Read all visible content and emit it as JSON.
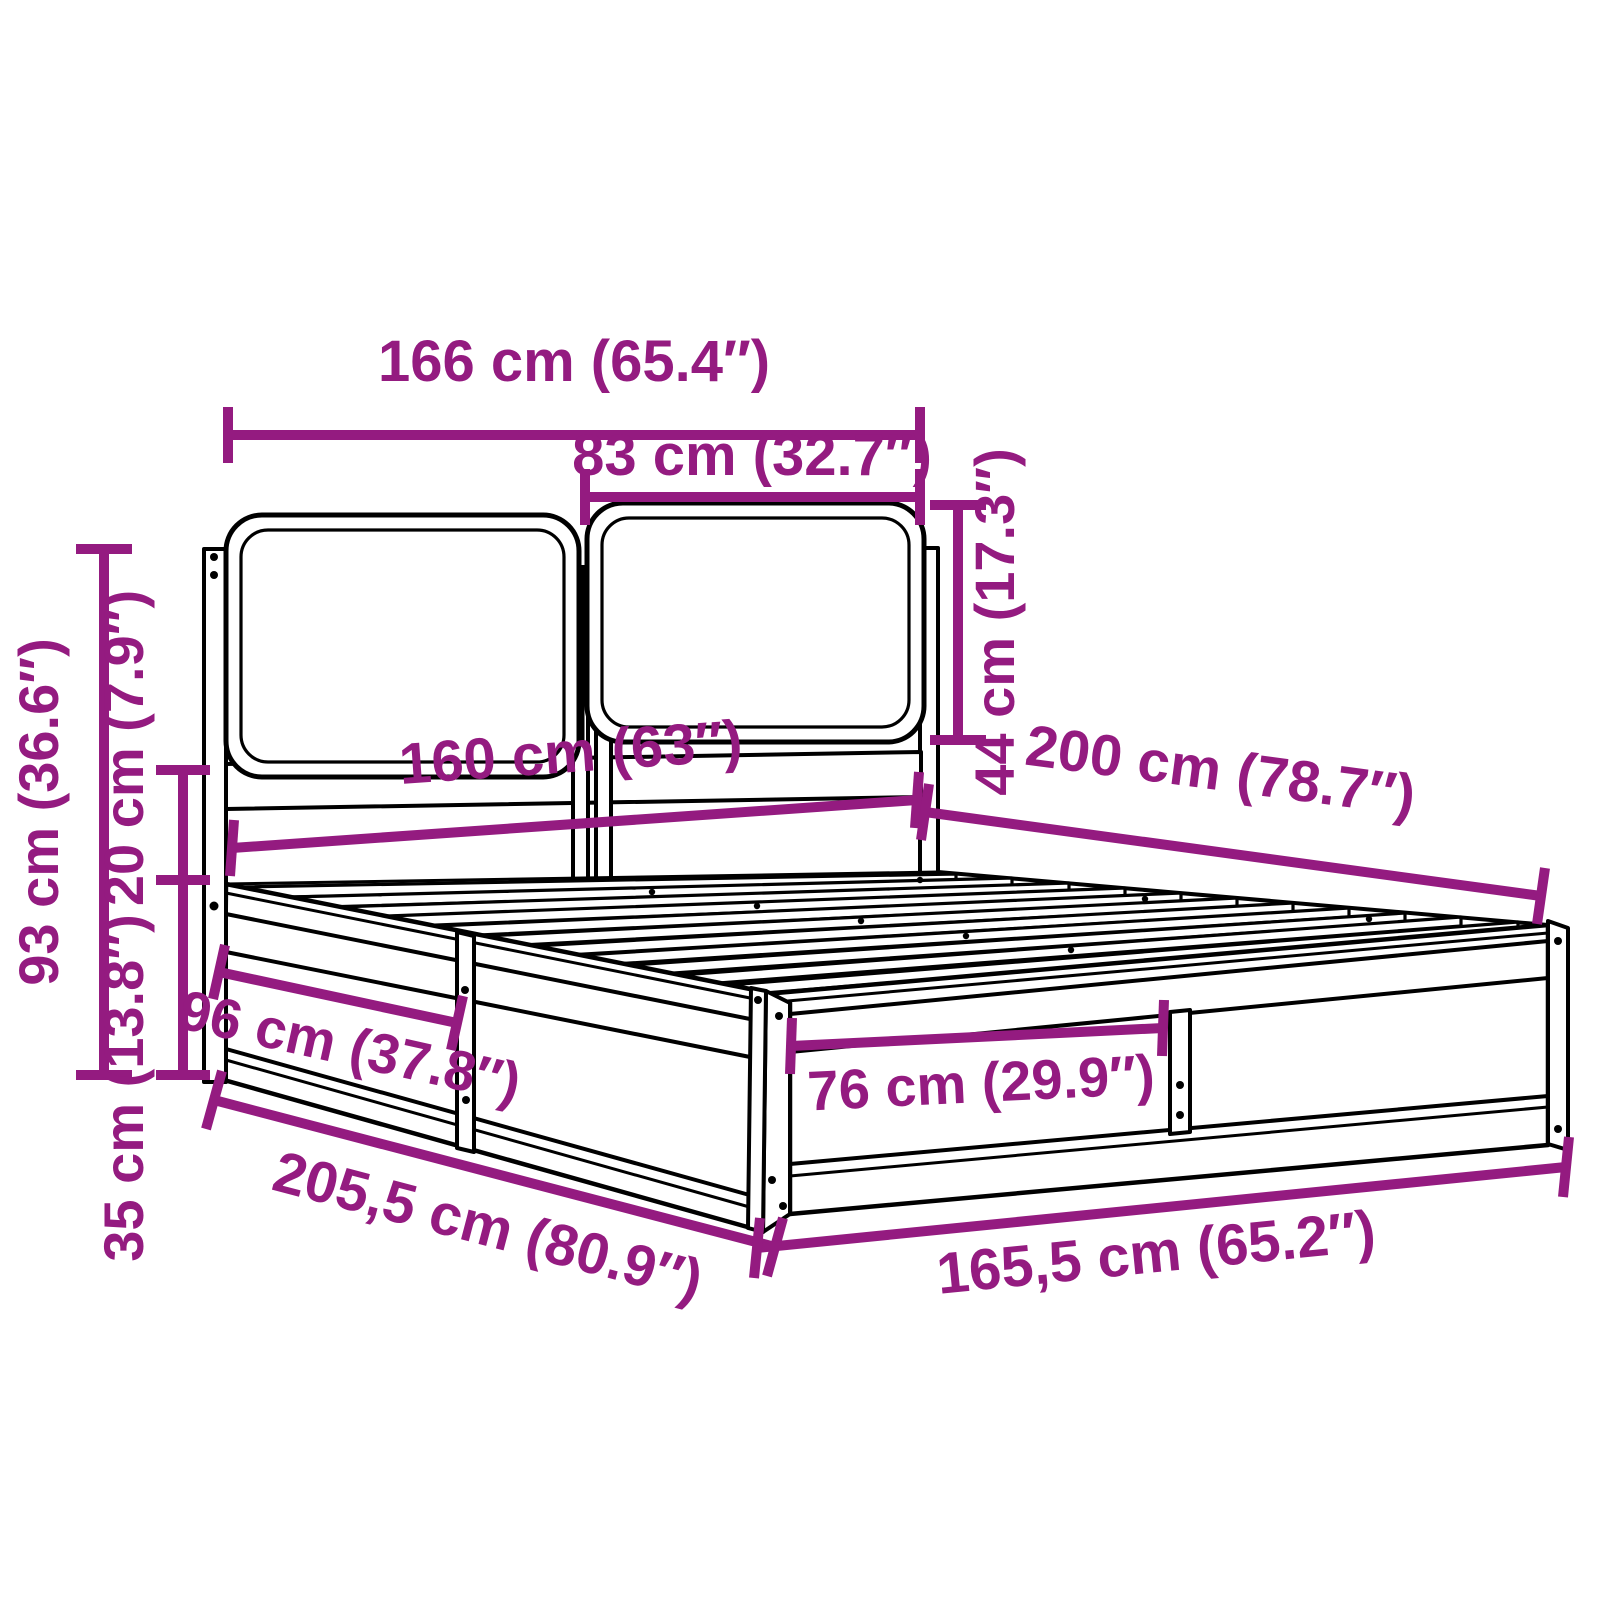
{
  "diagram": {
    "kind": "bed-frame-dimension-diagram",
    "description": "Line drawing of a bed frame with two headboard cushions and slatted base, annotated with purple dimension lines"
  },
  "colors": {
    "dimension": "#941B80",
    "outline": "#000000",
    "background": "#FFFFFF"
  },
  "dims": {
    "headboard_width": {
      "label": "166 cm (65.4″)",
      "cm": "166",
      "inches": "65.4"
    },
    "cushion_width": {
      "label": "83 cm (32.7″)",
      "cm": "83",
      "inches": "32.7"
    },
    "cushion_height": {
      "label": "44 cm (17.3″)",
      "cm": "44",
      "inches": "17.3"
    },
    "headboard_height": {
      "label": "93 cm (36.6″)",
      "cm": "93",
      "inches": "36.6"
    },
    "headboard_clearance": {
      "label": "20 cm (7.9″)",
      "cm": "20",
      "inches": "7.9"
    },
    "base_height": {
      "label": "35 cm (13.8″)",
      "cm": "35",
      "inches": "13.8"
    },
    "mattress_width": {
      "label": "160 cm (63″)",
      "cm": "160",
      "inches": "63"
    },
    "mattress_length": {
      "label": "200 cm (78.7″)",
      "cm": "200",
      "inches": "78.7"
    },
    "side_section_length": {
      "label": "96 cm (37.8″)",
      "cm": "96",
      "inches": "37.8"
    },
    "foot_section_width": {
      "label": "76 cm (29.9″)",
      "cm": "76",
      "inches": "29.9"
    },
    "frame_length": {
      "label": "205,5 cm (80.9″)",
      "cm": "205,5",
      "inches": "80.9"
    },
    "frame_width": {
      "label": "165,5 cm (65.2″)",
      "cm": "165,5",
      "inches": "65.2"
    }
  }
}
